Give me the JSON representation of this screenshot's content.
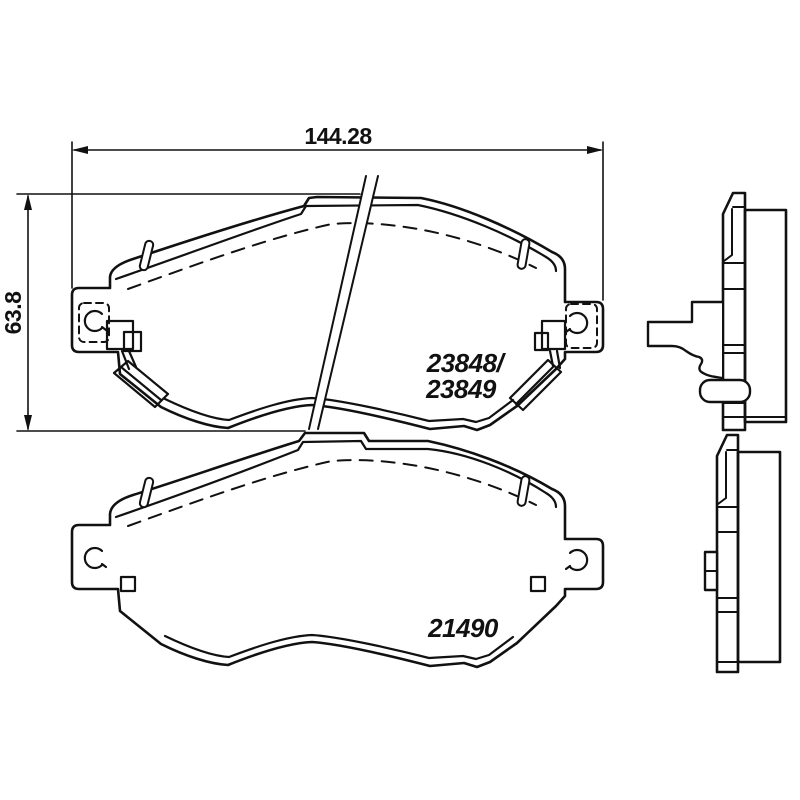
{
  "drawing": {
    "title": "brake-pad-technical-drawing",
    "background_color": "#ffffff",
    "line_color": "#111111",
    "dimensions": {
      "width": {
        "value": "144.28",
        "unit_hint": "mm"
      },
      "height": {
        "value": "63.8",
        "unit_hint": "mm"
      }
    },
    "parts": {
      "top_pad": {
        "label_line1": "23848/",
        "label_line2": "23849"
      },
      "bottom_pad": {
        "label": "21490"
      }
    },
    "views": {
      "front_top": "brake pad with wear sensor, front view",
      "front_bottom": "brake pad without wear sensor, front view",
      "side_top": "brake pad with clip, side profile",
      "side_bottom": "brake pad, side profile"
    }
  }
}
